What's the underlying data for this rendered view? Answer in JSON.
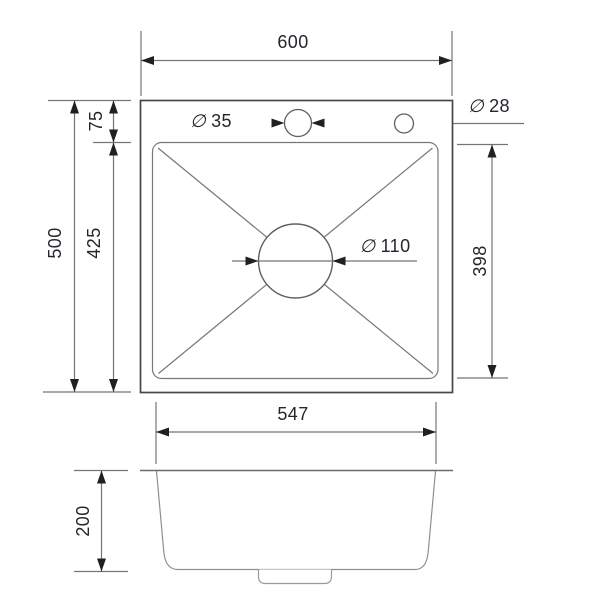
{
  "drawing": {
    "type": "sink-technical-drawing",
    "colors": {
      "ink_text": "#24262c",
      "line_gray": "#757575",
      "outline_dark": "#474747",
      "arrow_black": "#202020",
      "background": "#ffffff"
    },
    "top_view": {
      "overall_width": "600",
      "overall_depth": "500",
      "edge_to_bowl": "75",
      "bowl_to_front_edge": "425",
      "bowl_inner_length": "398",
      "faucet_hole": {
        "symbol": "∅",
        "value": "35"
      },
      "accessory_hole": {
        "symbol": "∅",
        "value": "28"
      },
      "drain_hole": {
        "symbol": "∅",
        "value": "110"
      }
    },
    "front_view": {
      "bowl_outer_width": "547",
      "bowl_depth": "200"
    }
  }
}
